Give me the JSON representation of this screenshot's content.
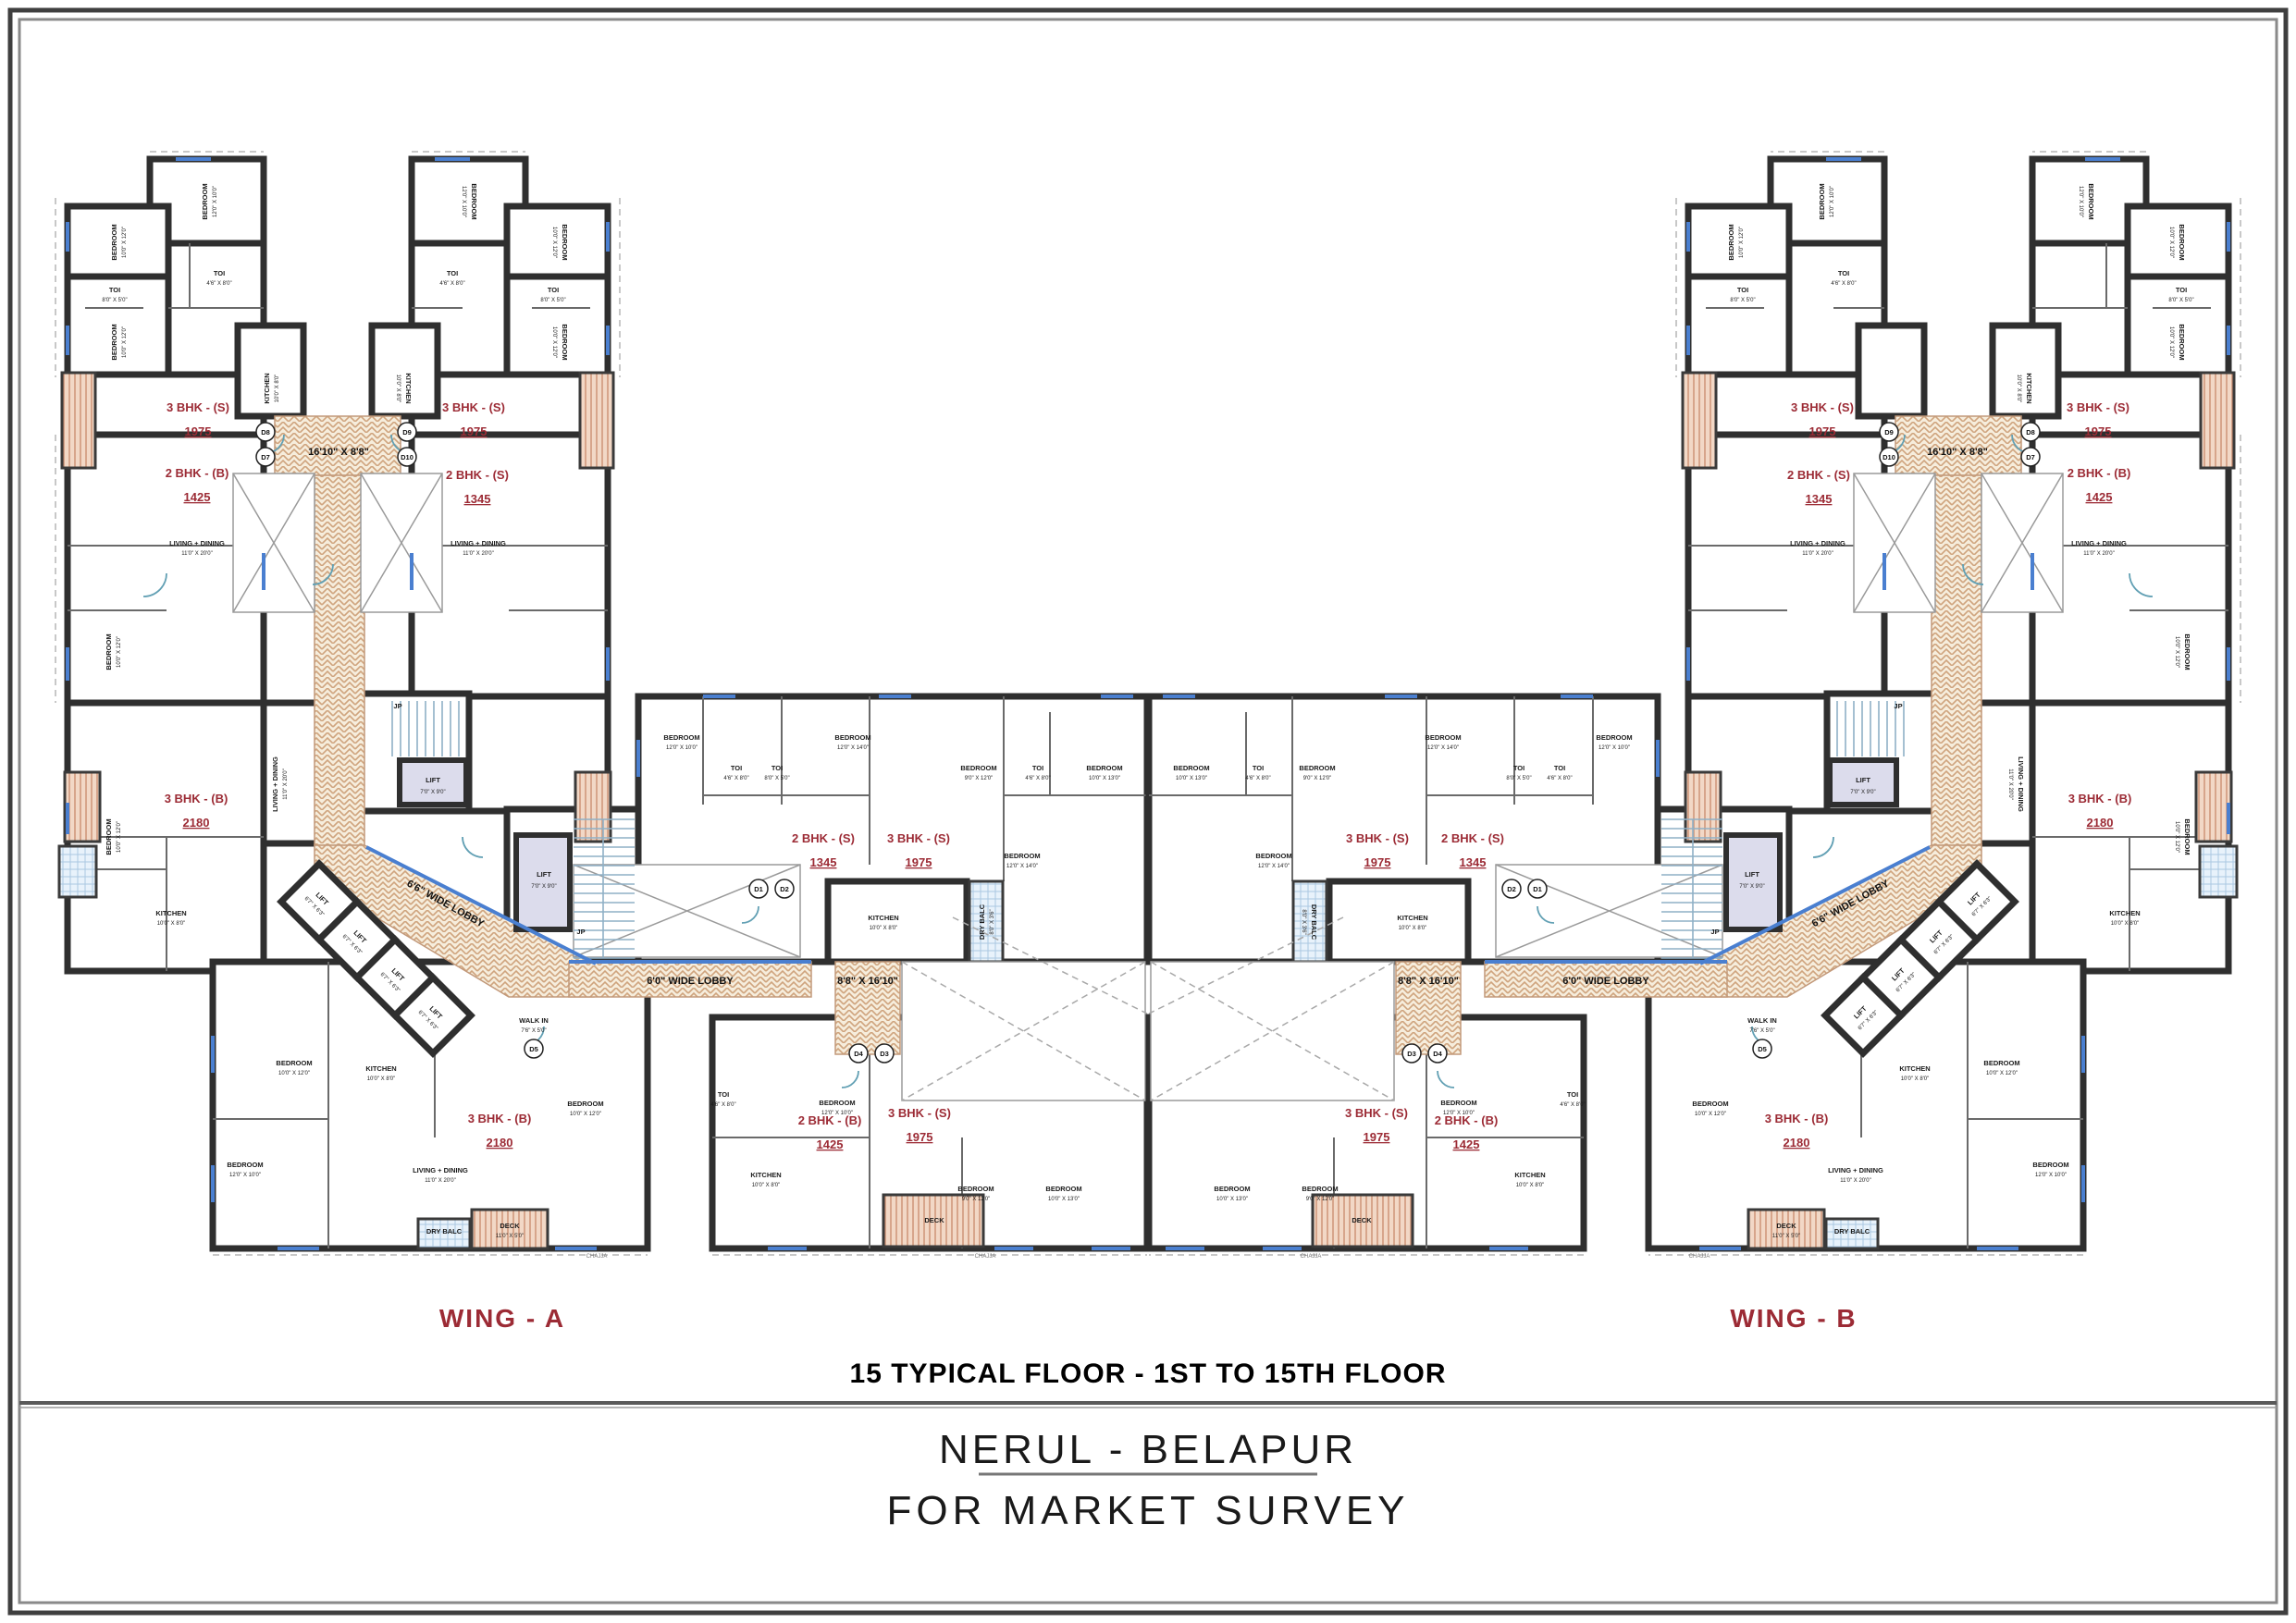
{
  "titles": {
    "floor": "15 TYPICAL FLOOR - 1ST TO 15TH FLOOR",
    "location": "NERUL - BELAPUR",
    "purpose": "FOR MARKET SURVEY"
  },
  "wings": [
    {
      "name": "WING - A"
    },
    {
      "name": "WING - B"
    }
  ],
  "unit_labels": [
    {
      "wing": "WING - A",
      "type": "3 BHK - (S)",
      "area": "1975"
    },
    {
      "wing": "WING - A",
      "type": "3 BHK - (S)",
      "area": "1975"
    },
    {
      "wing": "WING - A",
      "type": "2 BHK - (B)",
      "area": "1425"
    },
    {
      "wing": "WING - A",
      "type": "2 BHK - (S)",
      "area": "1345"
    },
    {
      "wing": "WING - A",
      "type": "3 BHK - (B)",
      "area": "2180"
    },
    {
      "wing": "WING - A",
      "type": "2 BHK - (S)",
      "area": "1345"
    },
    {
      "wing": "WING - A",
      "type": "3 BHK - (S)",
      "area": "1975"
    },
    {
      "wing": "WING - A",
      "type": "3 BHK - (B)",
      "area": "2180"
    },
    {
      "wing": "WING - A",
      "type": "2 BHK - (B)",
      "area": "1425"
    },
    {
      "wing": "WING - A",
      "type": "3 BHK - (S)",
      "area": "1975"
    },
    {
      "wing": "WING - B",
      "type": "3 BHK - (S)",
      "area": "1975"
    },
    {
      "wing": "WING - B",
      "type": "3 BHK - (S)",
      "area": "1975"
    },
    {
      "wing": "WING - B",
      "type": "2 BHK - (B)",
      "area": "1425"
    },
    {
      "wing": "WING - B",
      "type": "2 BHK - (S)",
      "area": "1345"
    },
    {
      "wing": "WING - B",
      "type": "3 BHK - (B)",
      "area": "2180"
    },
    {
      "wing": "WING - B",
      "type": "2 BHK - (S)",
      "area": "1345"
    },
    {
      "wing": "WING - B",
      "type": "3 BHK - (S)",
      "area": "1975"
    },
    {
      "wing": "WING - B",
      "type": "3 BHK - (B)",
      "area": "2180"
    },
    {
      "wing": "WING - B",
      "type": "2 BHK - (B)",
      "area": "1425"
    },
    {
      "wing": "WING - B",
      "type": "3 BHK - (S)",
      "area": "1975"
    }
  ],
  "lobby": {
    "t": "16'10\" X 8'8\"",
    "v": "8'8\" X 16'10\"",
    "h": "6'0\" WIDE LOBBY",
    "diag": "6'6\" WIDE LOBBY"
  },
  "rooms": {
    "bedroom": "BEDROOM",
    "kitchen": "KITCHEN",
    "toi": "TOI",
    "living": "LIVING + DINING",
    "dry_balc": "DRY BALC",
    "deck": "DECK",
    "walk_in": "WALK IN",
    "chajja": "CHAJJA",
    "lift": "LIFT",
    "jp": "JP"
  },
  "dims": {
    "d1": "12'0\" X 10'0\"",
    "d2": "10'0\" X 12'0\"",
    "d3": "8'0\" X 5'0\"",
    "d4": "4'6\" X 8'0\"",
    "d5": "10'0\" X 8'0\"",
    "d6": "11'0\" X 20'0\"",
    "d7": "12'0\" X 14'0\"",
    "d8": "9'0\" X 12'0\"",
    "d9": "10'0\" X 13'0\"",
    "lift_large": "7'0\" X 9'0\"",
    "lift_small": "6'7\" X 6'3\"",
    "deck": "11'0\" X 5'0\"",
    "dry_balc": "8'0\" X 3'6\"",
    "walk_in": "7'6\" X 5'0\""
  },
  "door_tags": [
    "D1",
    "D2",
    "D3",
    "D4",
    "D5",
    "D7",
    "D8",
    "D9",
    "D10"
  ],
  "colors": {
    "wall": "#2f2f2f",
    "unit_label_red": "#9c2b35",
    "lobby_hatch": "#cfa47e",
    "deck_hatch": "#cc8f72",
    "dry_balcony": "#aac8e2",
    "lift_fill": "#dcdcec",
    "window_blue": "#4a7fd0"
  }
}
